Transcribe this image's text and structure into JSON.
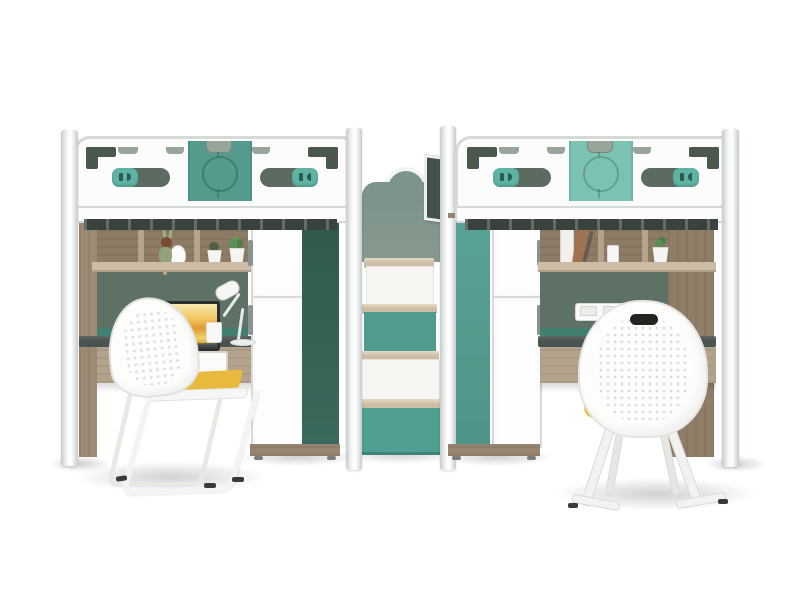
{
  "scene": {
    "label": "twin-loft-bed-workstation-set",
    "units": [
      {
        "side": "left",
        "objects": [
          "loft-bed",
          "guard-rail",
          "teal-headboard-panel",
          "rail-handles",
          "wardrobe",
          "dark-green-side-panel",
          "bookshelf",
          "doll-figurine",
          "plant-pot",
          "plant-pot",
          "desk",
          "white-drawer",
          "laptop",
          "desk-lamp",
          "mug",
          "chair-with-yellow-cushion"
        ]
      },
      {
        "side": "right",
        "objects": [
          "loft-bed",
          "guard-rail",
          "teal-headboard-panel",
          "rail-handles",
          "wardrobe",
          "teal-side-panel",
          "bookshelf",
          "books",
          "small-cup",
          "plant-pot",
          "desk",
          "white-drawer",
          "power-outlet",
          "mug",
          "chair-with-yellow-cushion-back-view"
        ]
      }
    ],
    "center": {
      "objects": [
        "storage-staircase",
        "wood-treads",
        "teal-risers",
        "white-risers",
        "teal-bottom-drawer",
        "wavy-sage-headboard",
        "safety-gate-panel"
      ]
    }
  },
  "colors": {
    "bg": "#ffffff",
    "frame_white": "#fbfcfb",
    "frame_border": "#d6dad7",
    "post_light": "#f5f7f6",
    "post_shade": "#c6ccc8",
    "teal_panel_left": "#549b8e",
    "teal_panel_right": "#7cc2b2",
    "teal_handle": "#5fb3a4",
    "teal_mid": "#58a295",
    "teal_step": "#4f9c8e",
    "teal_drawer": "#4f9f92",
    "green_dark_panel": "#30594d",
    "sage_accent": "#4b584e",
    "sage_light": "#97a699",
    "headboard_sage": "#7d948a",
    "wall_green": "#5d7164",
    "backsplash_teal": "#417f70",
    "desk_top": "#4a5350",
    "wood_light": "#cdbda6",
    "wood_mid": "#b3a28c",
    "wood_dark": "#95846f",
    "wood_side": "#9c8a75",
    "slat_dark": "#3a423e",
    "drawer_white": "#fbfbfa",
    "chair_yellow": "#e9b93d",
    "handle_grey": "#8a9390",
    "handle_dark": "#5b6b60",
    "laptop_dark": "#2b2f30"
  }
}
